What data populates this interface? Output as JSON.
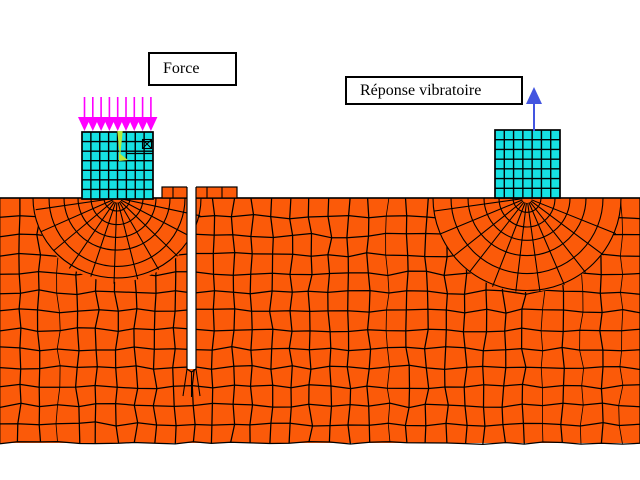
{
  "figure": {
    "background": "#FFFFFF",
    "labels": {
      "force": "Force",
      "response": "Réponse vibratoire"
    },
    "colors": {
      "soil_fill": "#FB5A09",
      "mesh_line": "#000000",
      "block_fill": "#16E1E3",
      "block_line": "#000000",
      "load_arrow": "#FF00FF",
      "response_arrow": "#4355E0",
      "axis_marker": "#B8E93C",
      "trench_fill": "#FFFFFF",
      "label_box_border": "#000000"
    },
    "soil": {
      "x": 0,
      "y": 198,
      "width": 640,
      "height": 245,
      "cols": 33,
      "rows": 13
    },
    "collar": {
      "x": 162,
      "y": 187,
      "width": 75,
      "height": 11,
      "vlines": [
        173,
        207,
        222
      ]
    },
    "trench": {
      "x": 187,
      "top": 187,
      "width": 9,
      "bottom": 369
    },
    "blocks": {
      "left": {
        "x": 82,
        "y": 132,
        "width": 71,
        "height": 67,
        "cols": 8,
        "rows": 7
      },
      "right": {
        "x": 495,
        "y": 130,
        "width": 65,
        "height": 68,
        "cols": 7,
        "rows": 7
      }
    },
    "fans": [
      {
        "cx": 117,
        "cy": 198,
        "radii": [
          13,
          26,
          39,
          53,
          68,
          84
        ],
        "spoke_step_deg": 16
      },
      {
        "cx": 527,
        "cy": 198,
        "radii": [
          14,
          28,
          43,
          59,
          76,
          94
        ],
        "spoke_step_deg": 15
      }
    ],
    "load_arrows": {
      "count": 9,
      "x_start": 84.5,
      "spacing": 8.3,
      "shaft_top": 97,
      "head_base": 117,
      "tip": 131,
      "head_half_width": 6.5
    },
    "response_arrow": {
      "x": 534,
      "shaft_bottom": 131,
      "shaft_top": 102,
      "head_base": 104,
      "tip": 87,
      "head_half_width": 8
    },
    "axis_marker": {
      "tri": [
        [
          117.3,
          131
        ],
        [
          122.7,
          131
        ],
        [
          120,
          158
        ]
      ],
      "foot": [
        [
          119,
          153
        ],
        [
          128,
          160
        ],
        [
          119,
          161
        ]
      ],
      "hline_y": 153.5,
      "hline_x1": 126,
      "hline_x2": 153,
      "xbox": {
        "x": 142.5,
        "y": 139.5,
        "size": 9
      }
    }
  }
}
